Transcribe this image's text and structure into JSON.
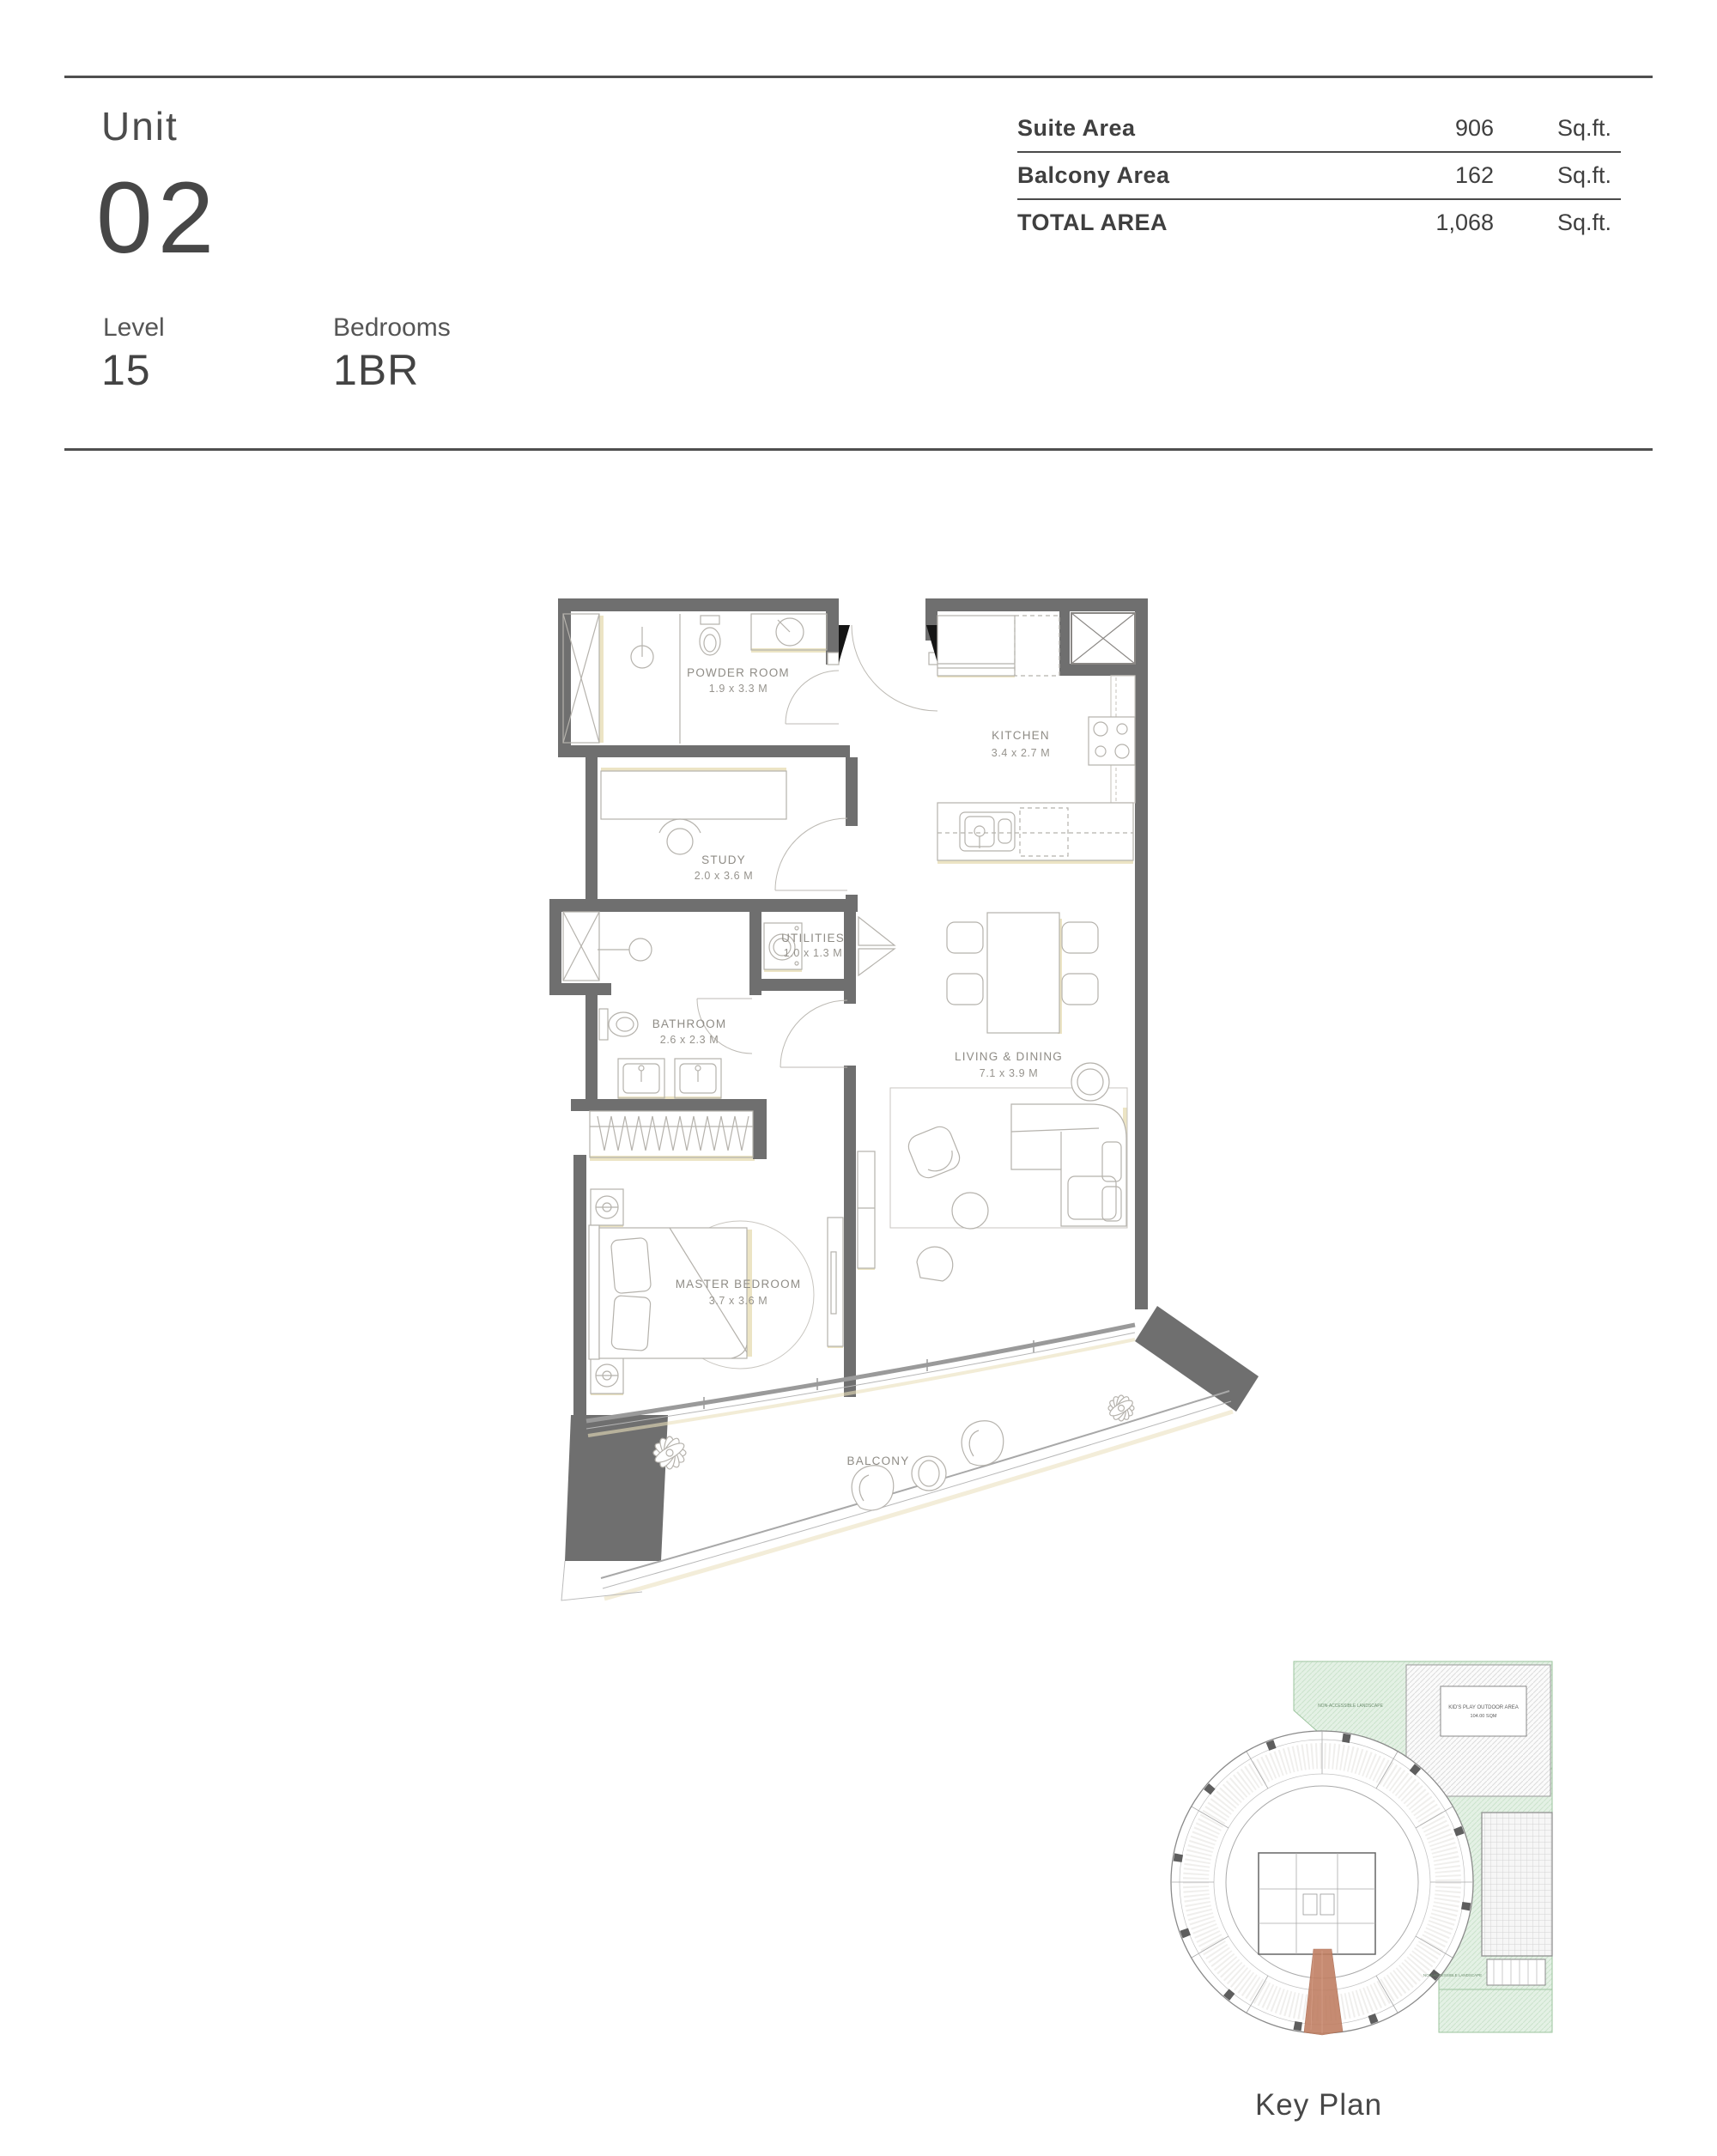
{
  "header": {
    "unit_label": "Unit",
    "unit_number": "02",
    "level_label": "Level",
    "level_value": "15",
    "bedrooms_label": "Bedrooms",
    "bedrooms_value": "1BR",
    "area_table": {
      "rows": [
        {
          "label": "Suite Area",
          "value": "906",
          "unit": "Sq.ft."
        },
        {
          "label": "Balcony Area",
          "value": "162",
          "unit": "Sq.ft."
        },
        {
          "label": "TOTAL AREA",
          "value": "1,068",
          "unit": "Sq.ft."
        }
      ]
    }
  },
  "floor_plan": {
    "rooms": [
      {
        "name": "POWDER ROOM",
        "dims": "1.9 x 3.3 M"
      },
      {
        "name": "STUDY",
        "dims": "2.0 x 3.6 M"
      },
      {
        "name": "KITCHEN",
        "dims": "3.4 x 2.7 M"
      },
      {
        "name": "UTILITIES",
        "dims": "1.0 x 1.3 M"
      },
      {
        "name": "BATHROOM",
        "dims": "2.6 x 2.3 M"
      },
      {
        "name": "LIVING & DINING",
        "dims": "7.1 x 3.9 M"
      },
      {
        "name": "MASTER BEDROOM",
        "dims": "3.7 x 3.6 M"
      }
    ],
    "balcony_label": "BALCONY"
  },
  "key_plan": {
    "caption": "Key Plan",
    "kids_play_line1": "KID'S PLAY OUTDOOR AREA",
    "kids_play_line2": "104.00 SQM",
    "landscape_label": "NON-ACCESSIBLE LANDSCAPE"
  },
  "colors": {
    "wall": "#6f6f6f",
    "shadow_tan": "#e9dfba",
    "highlight_unit": "#c07f63",
    "landscape_green": "#e4f1e5"
  }
}
